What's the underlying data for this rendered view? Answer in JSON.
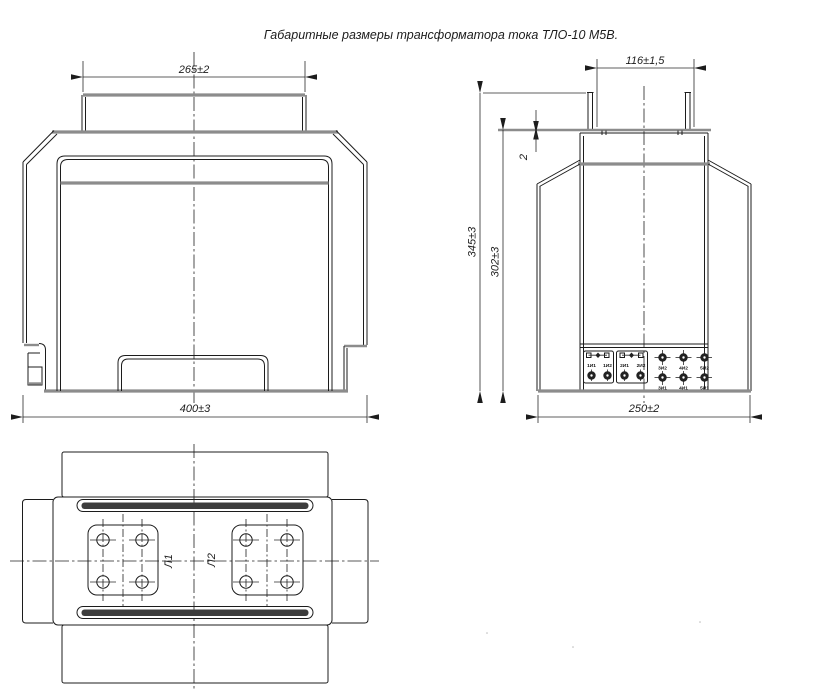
{
  "title": "Габаритные размеры трансформатора тока ТЛО-10 М5В.",
  "front_view": {
    "dim_width_top": "265±2",
    "dim_width_bottom": "400±3"
  },
  "side_view": {
    "dim_width_top": "116±1,5",
    "dim_width_bottom": "250±2",
    "dim_height_outer": "345±3",
    "dim_height_inner": "302±3",
    "dim_plate_thickness": "2",
    "terminals": {
      "group1_labels": [
        "1И1",
        "1И2"
      ],
      "group2_labels": [
        "2И1",
        "2И2"
      ],
      "row_top_labels": [
        "3И2",
        "4И2",
        "5И2"
      ],
      "row_bottom_labels": [
        "3И1",
        "4И1",
        "5И1"
      ]
    }
  },
  "plan_view": {
    "primary_terminal_left": "Л1",
    "primary_terminal_right": "Л2"
  },
  "colors": {
    "line": "#1c1c1c",
    "thick_line": "#8c8c8c",
    "background": "#ffffff"
  }
}
